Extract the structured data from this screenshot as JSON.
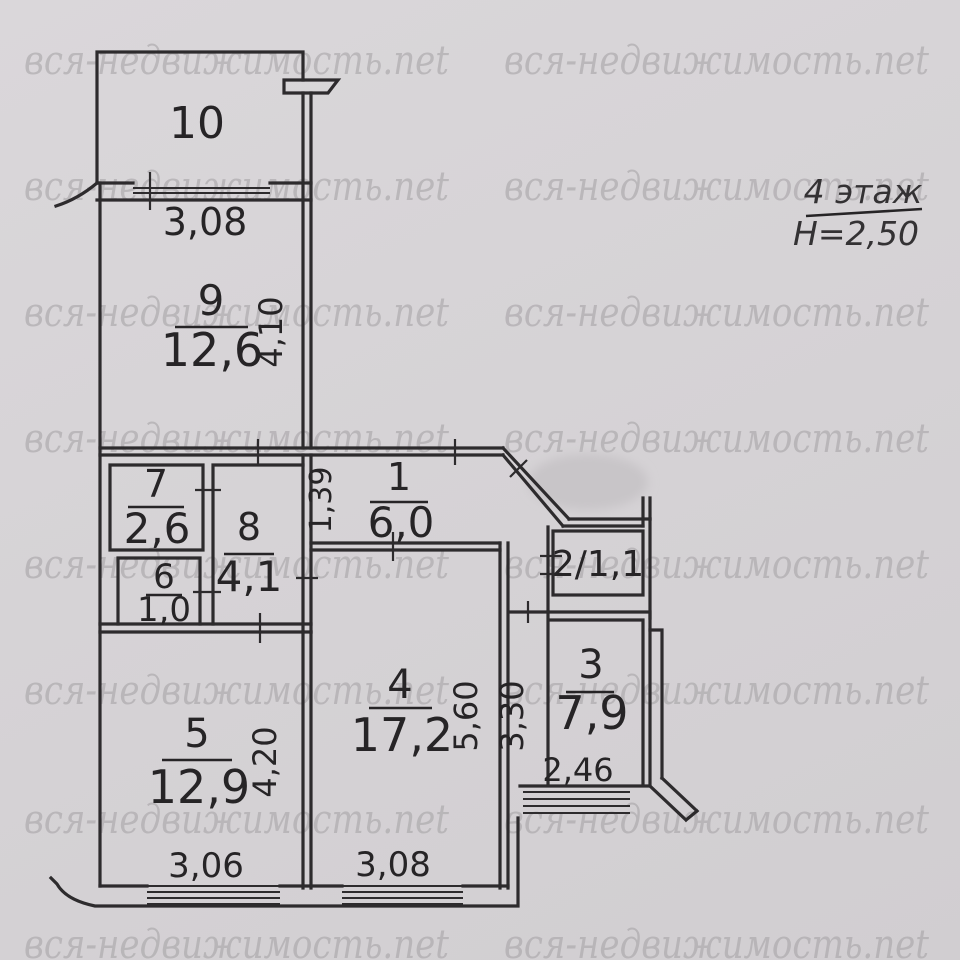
{
  "colors": {
    "paper": "#d6d3d6",
    "wall": "#2d2b2d",
    "ink": "#262426",
    "watermark": "#a3a0a3"
  },
  "watermark": {
    "text": "вся-недвижимость.net"
  },
  "title": {
    "floor": "4 этаж",
    "ceiling_height": "H=2,50"
  },
  "rooms": [
    {
      "number": "10"
    },
    {
      "number": "9",
      "area": "12,6"
    },
    {
      "number": "7",
      "area": "2,6"
    },
    {
      "number": "6",
      "area": "1,0"
    },
    {
      "number": "8",
      "area": "4,1"
    },
    {
      "number": "1",
      "area": "6,0"
    },
    {
      "number": "2/1,1"
    },
    {
      "number": "4",
      "area": "17,2"
    },
    {
      "number": "3",
      "area": "7,9"
    },
    {
      "number": "5",
      "area": "12,9"
    }
  ],
  "dimensions": {
    "top_window_width": "3,08",
    "room9_depth": "4,10",
    "hallway_width": "1,39",
    "room4_depth": "5,60",
    "room3_depth": "3,30",
    "room3_window_width": "2,46",
    "room5_depth": "4,20",
    "room5_window_width": "3,06",
    "room4_window_width": "3,08"
  }
}
